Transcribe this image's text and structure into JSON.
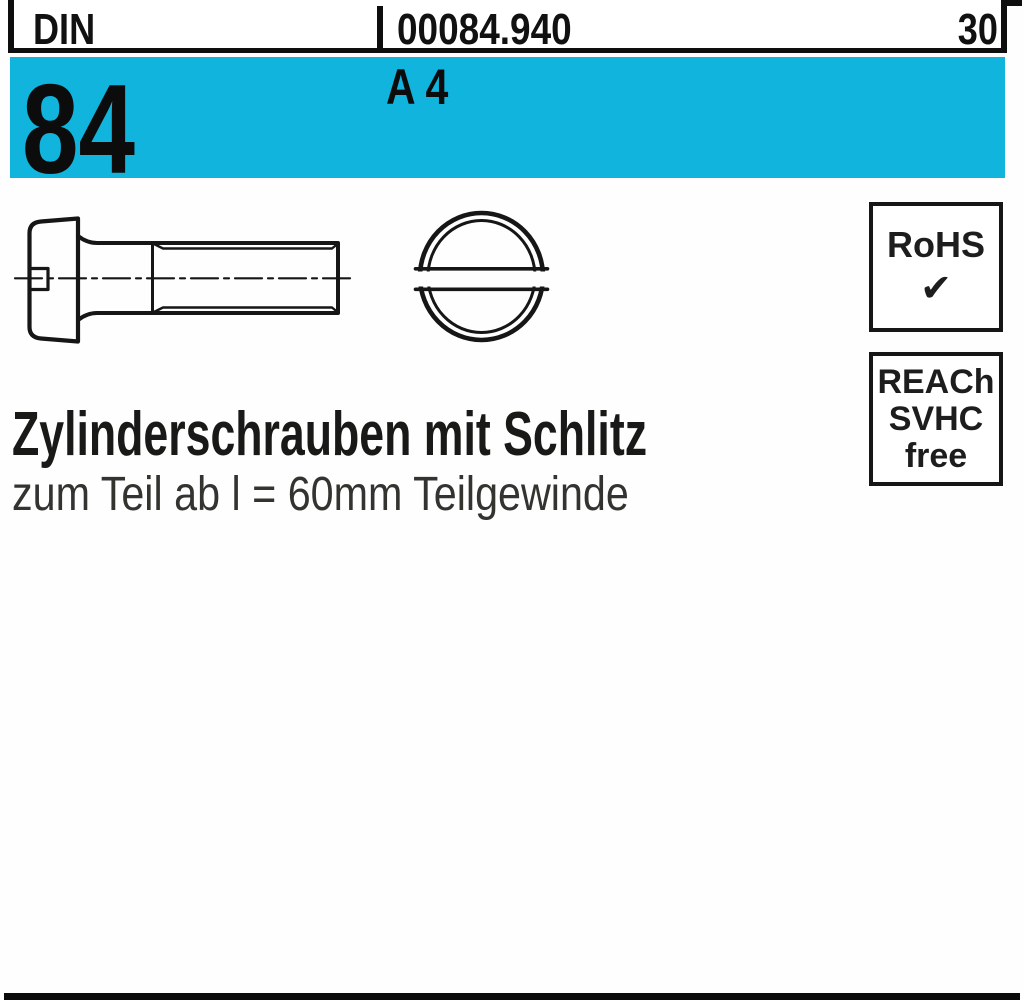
{
  "header": {
    "din_label": "DIN",
    "article_number": "00084.940",
    "page_number": "30"
  },
  "banner": {
    "standard_number": "84",
    "material_grade": "A 4",
    "background_color": "#10b4dc"
  },
  "compliance": {
    "rohs": {
      "label": "RoHS",
      "checkmark": "✔"
    },
    "reach": {
      "line1": "REACh",
      "line2": "SVHC",
      "line3": "free"
    }
  },
  "product": {
    "title": "Zylinderschrauben mit Schlitz",
    "subtitle": "zum Teil ab l = 60mm Teilgewinde"
  }
}
